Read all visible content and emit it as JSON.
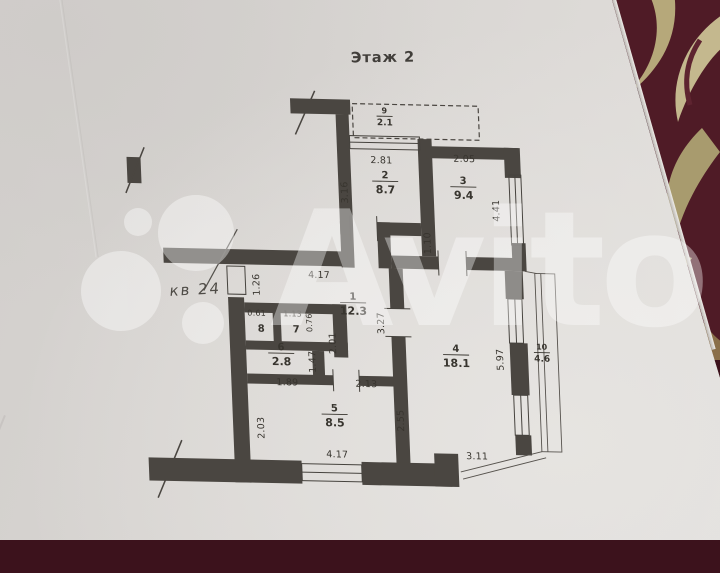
{
  "photo": {
    "title": "Этаж 2",
    "annotations": {
      "apartment_note": "кв 24"
    },
    "watermark": {
      "text": "Avito"
    },
    "colors": {
      "paper": "#d9d6d3",
      "plan_ink": "#4a4641",
      "fabric_base": "#4f1b26",
      "fabric_leaf": "#b9ab7d",
      "watermark": "rgba(255,255,255,0.38)"
    },
    "plan": {
      "rooms": [
        {
          "num": "9",
          "area": "2.1",
          "x": 252,
          "y": 16,
          "small": true
        },
        {
          "num": "2",
          "area": "8.7",
          "x": 250,
          "y": 81
        },
        {
          "num": "3",
          "area": "9.4",
          "x": 328,
          "y": 85
        },
        {
          "num": "1",
          "area": "12.3",
          "x": 213,
          "y": 203
        },
        {
          "num": "8",
          "area": "",
          "x": 120,
          "y": 230
        },
        {
          "num": "7",
          "area": "",
          "x": 155,
          "y": 230
        },
        {
          "num": "6",
          "area": "2.8",
          "x": 139,
          "y": 255
        },
        {
          "num": "5",
          "area": "8.5",
          "x": 190,
          "y": 315
        },
        {
          "num": "4",
          "area": "18.1",
          "x": 314,
          "y": 253
        },
        {
          "num": "10",
          "area": "4.6",
          "x": 400,
          "y": 249,
          "small": true
        }
      ],
      "dimensions": [
        {
          "v": "2.81",
          "x": 247,
          "y": 63,
          "rot": 0
        },
        {
          "v": "3.16",
          "x": 212,
          "y": 93,
          "rot": -90
        },
        {
          "v": "2.05",
          "x": 330,
          "y": 60,
          "rot": 0
        },
        {
          "v": "4.41",
          "x": 363,
          "y": 108,
          "rot": -90
        },
        {
          "v": "1.10",
          "x": 293,
          "y": 142,
          "rot": -90
        },
        {
          "v": "4.17",
          "x": 180,
          "y": 179,
          "rot": 0
        },
        {
          "v": "1.26",
          "x": 120,
          "y": 187,
          "rot": -90
        },
        {
          "v": "3.27",
          "x": 243,
          "y": 223,
          "rot": -90
        },
        {
          "v": "0.61",
          "x": 116,
          "y": 218,
          "rot": 0,
          "s": true
        },
        {
          "v": "1.13",
          "x": 152,
          "y": 218,
          "rot": 0,
          "s": true
        },
        {
          "v": "0.76",
          "x": 171,
          "y": 224,
          "rot": -90,
          "s": true
        },
        {
          "v": "2.01",
          "x": 194,
          "y": 244,
          "rot": -90
        },
        {
          "v": "1.47",
          "x": 173,
          "y": 263,
          "rot": -90
        },
        {
          "v": "1.89",
          "x": 144,
          "y": 287,
          "rot": 0
        },
        {
          "v": "2.13",
          "x": 223,
          "y": 287,
          "rot": 0
        },
        {
          "v": "2.03",
          "x": 119,
          "y": 330,
          "rot": -90
        },
        {
          "v": "2.55",
          "x": 259,
          "y": 320,
          "rot": -90
        },
        {
          "v": "5.97",
          "x": 361,
          "y": 257,
          "rot": -90
        },
        {
          "v": "4.17",
          "x": 191,
          "y": 358,
          "rot": 0
        },
        {
          "v": "3.11",
          "x": 331,
          "y": 357,
          "rot": 0
        }
      ]
    }
  }
}
